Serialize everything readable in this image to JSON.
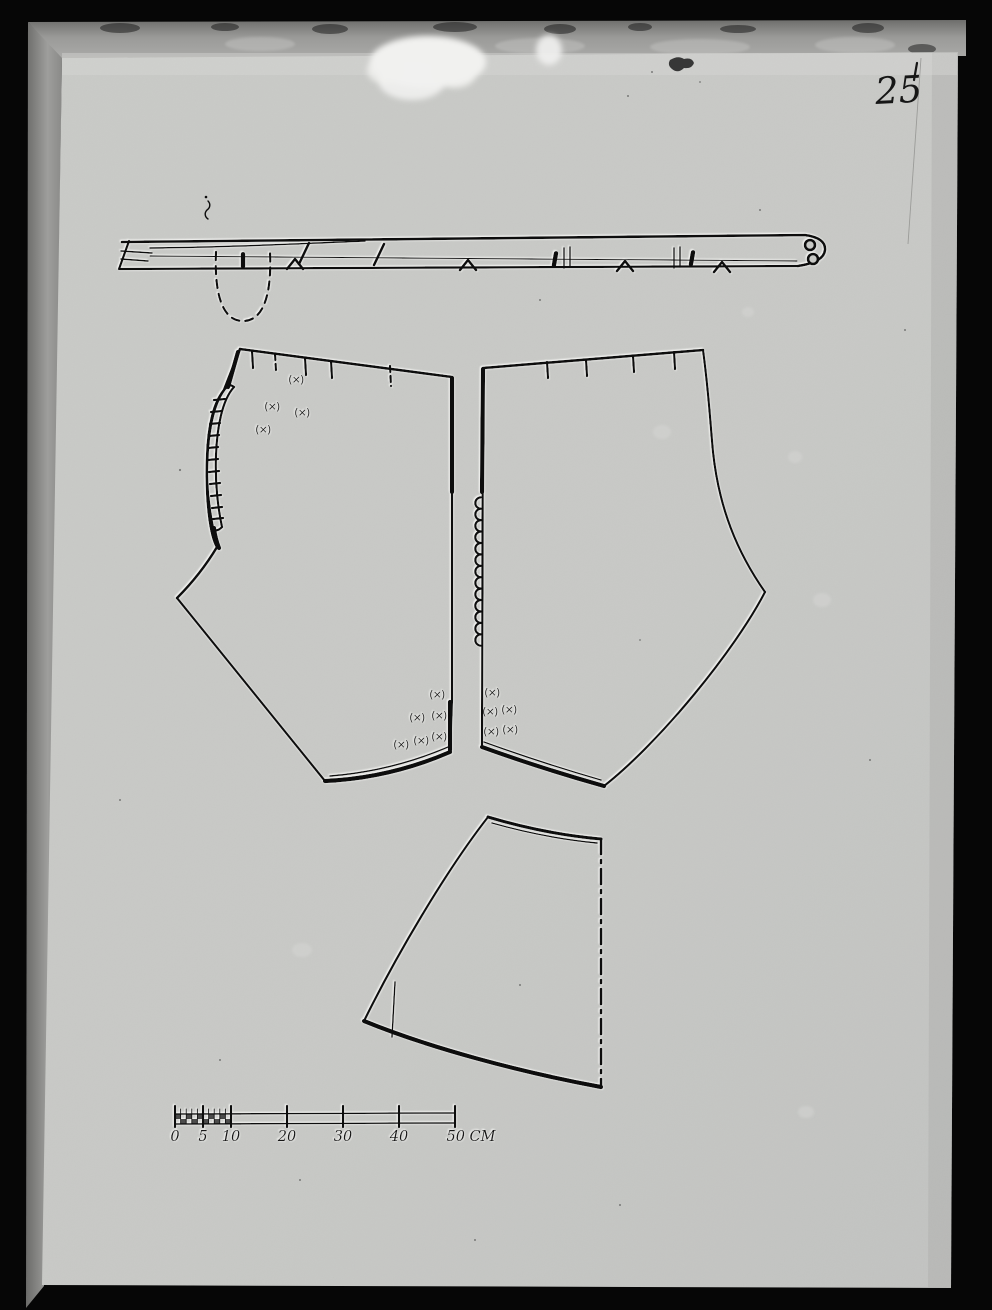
{
  "photo": {
    "handwritten_page_number": "25",
    "colors": {
      "background": "#060606",
      "frame": "#949492",
      "paper": "#c8c9c6",
      "ink": "#0c0c0c",
      "halo": "#f4f4f2"
    }
  },
  "pattern": {
    "annotation_symbol": "(×)",
    "cross_marks": {
      "left_piece_top": [
        [
          296,
          379
        ],
        [
          272,
          406
        ],
        [
          302,
          412
        ],
        [
          263,
          429
        ]
      ],
      "left_piece_bottom": [
        [
          437,
          694
        ],
        [
          417,
          717
        ],
        [
          439,
          715
        ],
        [
          401,
          744
        ],
        [
          421,
          740
        ],
        [
          439,
          736
        ]
      ],
      "right_piece_bottom": [
        [
          492,
          692
        ],
        [
          490,
          711
        ],
        [
          509,
          709
        ],
        [
          491,
          731
        ],
        [
          510,
          729
        ]
      ]
    },
    "edge_ticks": {
      "left_piece_top": [
        [
          252,
          351,
          253,
          368,
          0
        ],
        [
          275,
          354,
          276,
          371,
          1
        ],
        [
          305,
          358,
          306,
          375,
          0
        ],
        [
          331,
          361,
          332,
          378,
          0
        ],
        [
          390,
          366,
          391,
          386,
          1
        ]
      ],
      "right_piece_top": [
        [
          547,
          362,
          548,
          378,
          0
        ],
        [
          586,
          360,
          587,
          376,
          0
        ],
        [
          633,
          356,
          634,
          372,
          0
        ],
        [
          674,
          352,
          675,
          369,
          0
        ]
      ]
    },
    "waistband": {
      "buttons": [
        [
          810,
          245
        ],
        [
          813,
          259
        ]
      ],
      "buttonhole_slots": [
        [
          243,
          252,
          0
        ],
        [
          555,
          251,
          10
        ],
        [
          692,
          250,
          10
        ]
      ],
      "notches": [
        [
          295,
          264
        ],
        [
          468,
          265
        ],
        [
          625,
          266
        ],
        [
          722,
          267
        ]
      ],
      "slashes": [
        [
          304,
          253
        ],
        [
          379,
          254
        ]
      ],
      "division_lines": [
        567,
        677
      ]
    },
    "scallop_loops": {
      "x": 481,
      "y_start": 503,
      "y_end": 640,
      "count": 13,
      "radius": 5.7
    }
  },
  "scale_bar": {
    "unit": "CM",
    "values": [
      0,
      5,
      10,
      20,
      30,
      40,
      50
    ],
    "labels": [
      "0",
      "5",
      "10",
      "20",
      "30",
      "40",
      "50 CM"
    ],
    "minor_ticks_range_cm": [
      0,
      10
    ],
    "length_cm": 50
  }
}
